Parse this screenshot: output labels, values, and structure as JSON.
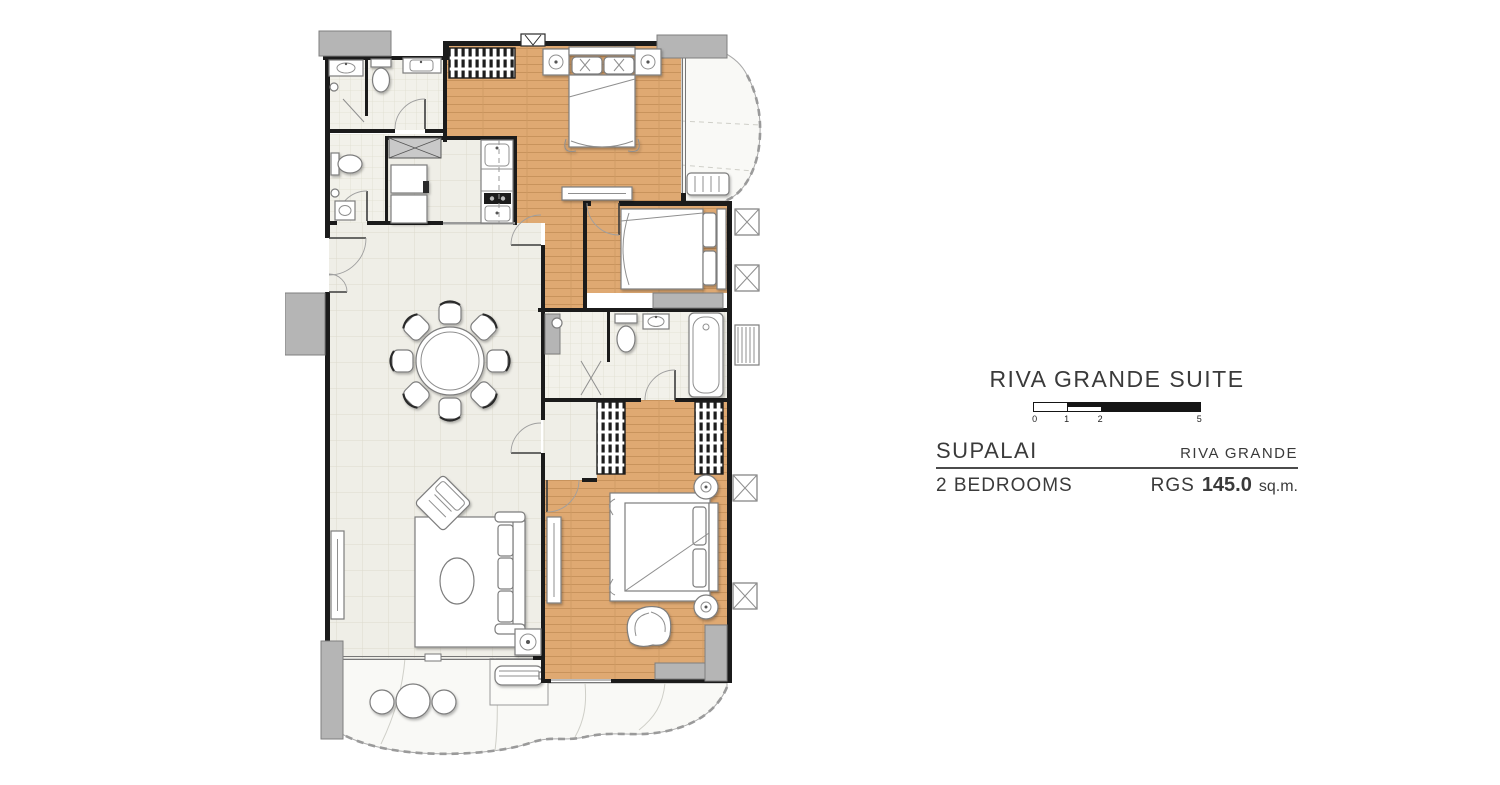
{
  "panel": {
    "title": "RIVA GRANDE SUITE",
    "scale_bar": {
      "ticks": [
        "0",
        "1",
        "2",
        "5"
      ]
    },
    "brand": "SUPALAI",
    "project": "RIVA GRANDE",
    "unit_type": "2 BEDROOMS",
    "area_code": "RGS",
    "area_value": "145.0",
    "area_unit": "sq.m."
  },
  "plan": {
    "colors": {
      "wall": "#1b1b1b",
      "wood_floor": "#dfa972",
      "tile_floor": "#efeee7",
      "bath_tile": "#f2f1ea",
      "concrete_gray": "#b5b5b5",
      "balcony": "#f9f9f6"
    }
  }
}
